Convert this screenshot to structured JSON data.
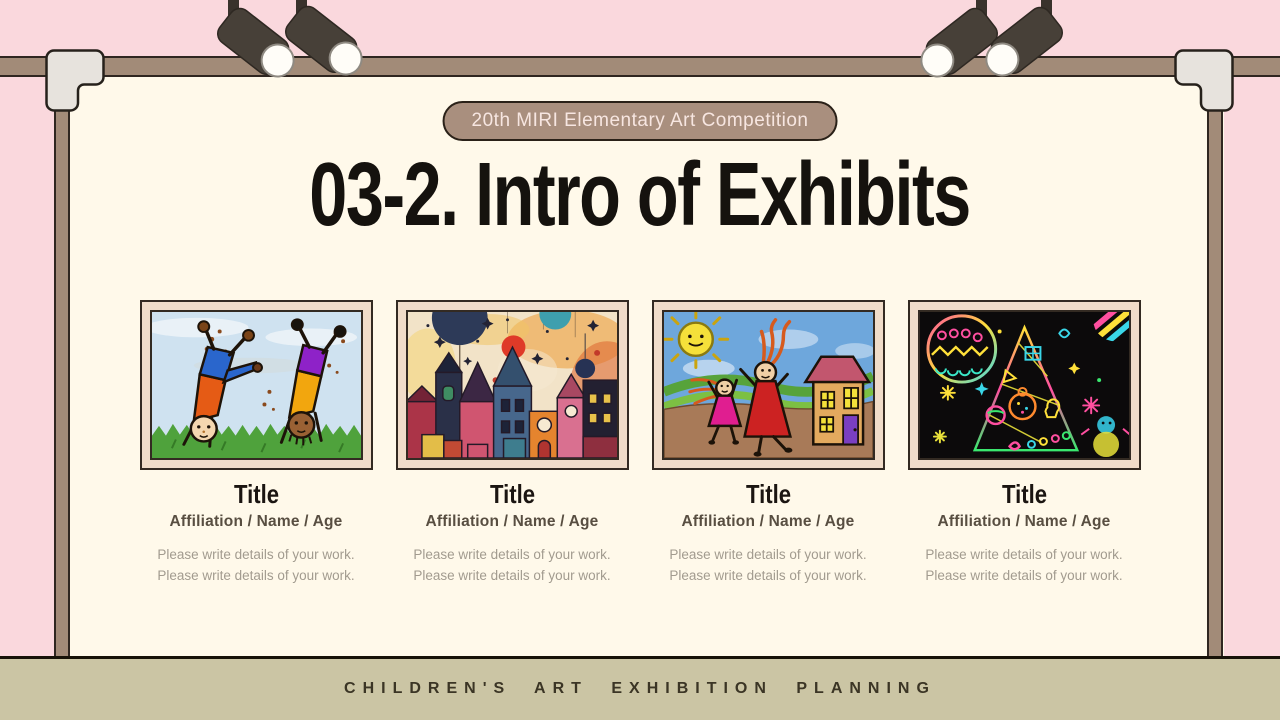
{
  "slide": {
    "badge_label": "20th MIRI Elementary Art Competition",
    "title": "03-2. Intro of Exhibits",
    "footer_text": "CHILDREN'S ART EXHIBITION PLANNING"
  },
  "cards": [
    {
      "title": "Title",
      "subtitle": "Affiliation / Name / Age",
      "details": [
        "Please write details of your work.",
        "Please write details of your work."
      ],
      "artwork_alt": "crayon drawing of two children doing cartwheels on grass"
    },
    {
      "title": "Title",
      "subtitle": "Affiliation / Name / Age",
      "details": [
        "Please write details of your work.",
        "Please write details of your work."
      ],
      "artwork_alt": "watercolor painting of a colorful fantasy town with balloons and stars"
    },
    {
      "title": "Title",
      "subtitle": "Affiliation / Name / Age",
      "details": [
        "Please write details of your work.",
        "Please write details of your work."
      ],
      "artwork_alt": "crayon drawing of mother and child playing outside a house under the sun"
    },
    {
      "title": "Title",
      "subtitle": "Affiliation / Name / Age",
      "details": [
        "Please write details of your work.",
        "Please write details of your work."
      ],
      "artwork_alt": "rainbow scratch art of a christmas tree, ornaments and snowman on black"
    }
  ],
  "colors": {
    "background_pink": "#fad8dd",
    "board_cream": "#fff9ea",
    "frame_brown": "#a28b78",
    "badge_brown": "#a98f7e",
    "card_mat": "#f0dcc9",
    "footer_khaki": "#cbc5a4",
    "title_black": "#15120e"
  }
}
